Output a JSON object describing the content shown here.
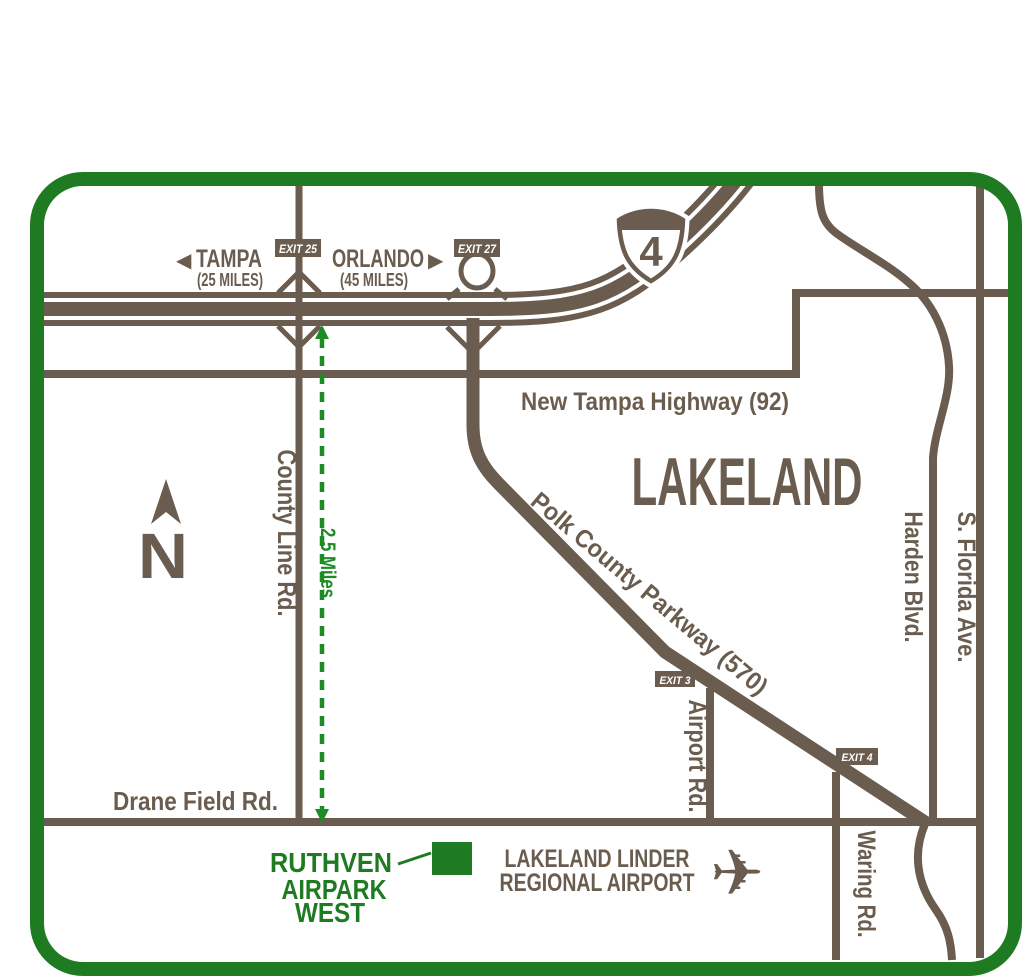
{
  "map": {
    "city_label": "LAKELAND",
    "compass": {
      "letter": "N"
    },
    "scale": {
      "label": "2.5 Miles"
    },
    "interstate": {
      "number": "4"
    },
    "destinations": {
      "tampa": {
        "arrow": "◀",
        "name": "TAMPA",
        "distance": "(25 MILES)"
      },
      "orlando": {
        "name": "ORLANDO",
        "arrow": "▶",
        "distance": "(45 MILES)"
      }
    },
    "exits": {
      "exit25": "EXIT 25",
      "exit27": "EXIT 27",
      "exit3": "EXIT 3",
      "exit4": "EXIT 4"
    },
    "roads": {
      "new_tampa_highway": "New Tampa Highway (92)",
      "county_line": "County Line Rd.",
      "polk_parkway": "Polk County Parkway (570)",
      "harden": "Harden Blvd.",
      "s_florida": "S. Florida Ave.",
      "airport_rd": "Airport Rd.",
      "waring": "Waring Rd.",
      "drane_field": "Drane Field Rd."
    },
    "pois": {
      "ruthven": {
        "line1": "RUTHVEN",
        "line2": "AIRPARK",
        "line3": "WEST"
      },
      "airport": {
        "line1": "LAKELAND LINDER",
        "line2": "REGIONAL AIRPORT",
        "plane_icon": "✈"
      }
    },
    "colors": {
      "road_brown": "#6a5c4e",
      "map_green": "#1e7b21",
      "scale_green": "#1f8b24",
      "background": "#ffffff"
    }
  }
}
